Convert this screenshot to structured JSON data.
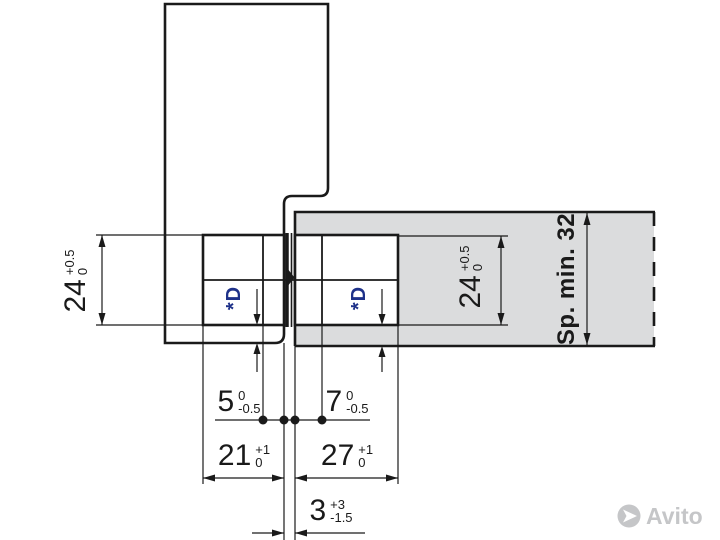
{
  "drawing_title": "hinge-installation-cross-section",
  "dimensions": {
    "hinge_height_door": {
      "value": "24",
      "tol_upper": "+0.5",
      "tol_lower": "0"
    },
    "hinge_height_frame": {
      "value": "24",
      "tol_upper": "+0.5",
      "tol_lower": "0"
    },
    "door_edge_offset": {
      "value": "5",
      "tol_upper": "0",
      "tol_lower": "-0.5"
    },
    "frame_edge_offset": {
      "value": "7",
      "tol_upper": "0",
      "tol_lower": "-0.5"
    },
    "door_drill_depth": {
      "value": "21",
      "tol_upper": "+1",
      "tol_lower": "0"
    },
    "frame_drill_depth": {
      "value": "27",
      "tol_upper": "+1",
      "tol_lower": "0"
    },
    "gap_door_frame": {
      "value": "3",
      "tol_upper": "+3",
      "tol_lower": "-1.5"
    },
    "frame_min_thickness": "Sp. min. 32",
    "drill_diameter_left": "*D",
    "drill_diameter_right": "*D"
  },
  "colors": {
    "line": "#1a1a1a",
    "panel_gray": "#dbdcdd",
    "accent_blue": "#1e3189",
    "watermark_gray": "#c5c6c8"
  },
  "watermark": {
    "text": "Avito"
  }
}
